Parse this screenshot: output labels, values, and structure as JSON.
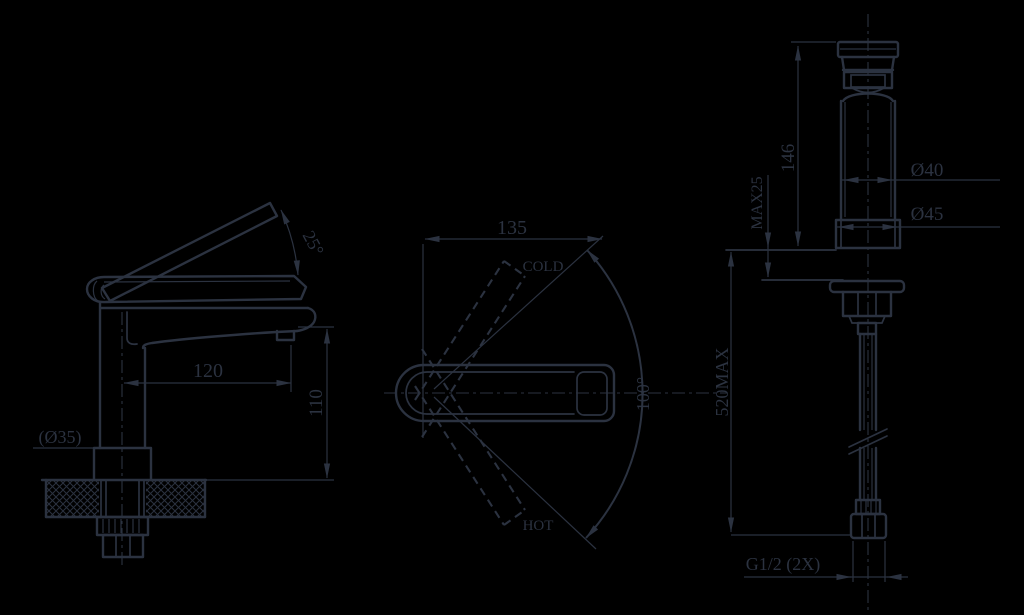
{
  "colors": {
    "background": "#000000",
    "line": "#2b3240"
  },
  "drawing": {
    "side_view": {
      "angle_label": "25°",
      "hole_label": "(Ø35)",
      "reach_label": "120",
      "height_label": "110"
    },
    "top_view": {
      "width_label": "135",
      "cold_label": "COLD",
      "hot_label": "HOT",
      "swivel_label": "100°"
    },
    "front_view": {
      "height_label": "146",
      "deck_label": "MAX25",
      "body_dia_label": "Ø40",
      "base_dia_label": "Ø45",
      "hose_label": "520MAX",
      "thread_label": "G1/2 (2X)"
    }
  }
}
